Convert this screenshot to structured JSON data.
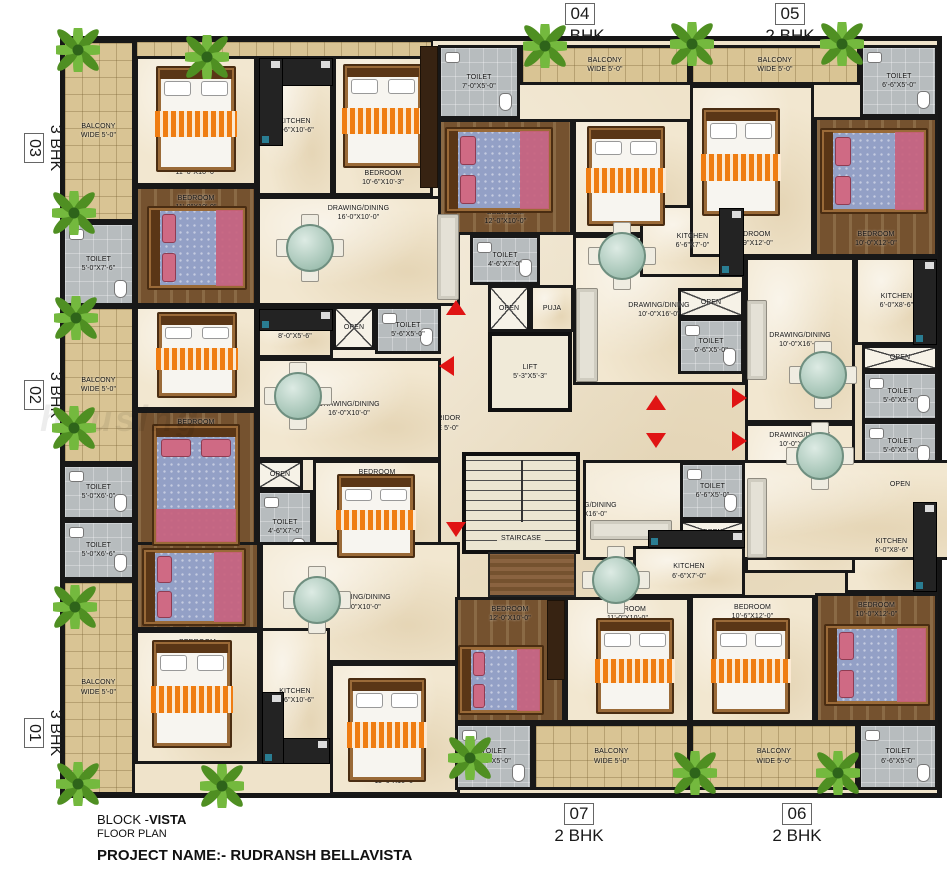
{
  "footer": {
    "block_prefix": "BLOCK -",
    "block_name": "VISTA",
    "floor_plan": "FLOOR PLAN",
    "project": "PROJECT NAME:- RUDRANSH BELLAVISTA"
  },
  "watermark": "housing",
  "units": [
    {
      "num": "04",
      "type": "2 BHK"
    },
    {
      "num": "05",
      "type": "2 BHK"
    },
    {
      "num": "03",
      "type": "3 BHK"
    },
    {
      "num": "02",
      "type": "3 BHK"
    },
    {
      "num": "01",
      "type": "3 BHK"
    },
    {
      "num": "07",
      "type": "2 BHK"
    },
    {
      "num": "06",
      "type": "2 BHK"
    }
  ],
  "colors": {
    "wall": "#181818",
    "arrow_red": "#e01414",
    "bed_orange": "#ef7d12",
    "bed_blue": "#93a0c6",
    "balcony_tan": "#d9c494",
    "toilet_gray": "#b7bcbe",
    "plant_green": "#74b93e"
  },
  "icons": {
    "plant": "plant-icon",
    "bed": "bed-icon",
    "dining_table": "dining-table-icon",
    "sofa": "sofa-icon",
    "counter": "kitchen-counter-icon",
    "arrow": "direction-arrow-icon"
  },
  "rooms": [
    {
      "id": "bal03",
      "name": "BALCONY",
      "dims": "WIDE 5'-0\""
    },
    {
      "id": "toi03",
      "name": "TOILET",
      "dims": "5'-0\"X7'-6\""
    },
    {
      "id": "bed03a",
      "name": "BEDROOM",
      "dims": "11'-0\"X10'-0\""
    },
    {
      "id": "bed03b",
      "name": "BEDROOM",
      "dims": "11'-0\"X10'-0\""
    },
    {
      "id": "kit03",
      "name": "KITCHEN",
      "dims": "6'-6\"X10'-6\""
    },
    {
      "id": "bed03c",
      "name": "BEDROOM",
      "dims": "10'-6\"X10'-3\""
    },
    {
      "id": "drw03",
      "name": "DRAWING/DINING",
      "dims": "16'-0\"X10'-0\""
    },
    {
      "id": "bal02",
      "name": "BALCONY",
      "dims": "WIDE 5'-0\""
    },
    {
      "id": "toi02a",
      "name": "TOILET",
      "dims": "5'-0\"X6'-0\""
    },
    {
      "id": "bed02a",
      "name": "BEDROOM",
      "dims": "12'-0\"X10'-0\""
    },
    {
      "id": "bed02b",
      "name": "BEDROOM",
      "dims": "12'-0\"X10'-0\""
    },
    {
      "id": "kit02",
      "name": "KITCHEN",
      "dims": "8'-0\"X5'-6\""
    },
    {
      "id": "open02",
      "name": "OPEN",
      "dims": ""
    },
    {
      "id": "toi02b",
      "name": "TOILET",
      "dims": "5'-6\"X5'-0\""
    },
    {
      "id": "drw02",
      "name": "DRAWING/DINING",
      "dims": "16'-0\"X10'-0\""
    },
    {
      "id": "open02b",
      "name": "OPEN",
      "dims": ""
    },
    {
      "id": "toi02c",
      "name": "TOILET",
      "dims": "4'-6\"X7'-0\""
    },
    {
      "id": "bed02c",
      "name": "BEDROOM",
      "dims": "11'-0\"X10'-0\""
    },
    {
      "id": "toi01",
      "name": "TOILET",
      "dims": "5'-0\"X6'-6\""
    },
    {
      "id": "bal01",
      "name": "BALCONY",
      "dims": "WIDE 5'-0\""
    },
    {
      "id": "bed01a",
      "name": "BEDROOM",
      "dims": "12'-0\"X10'-3\""
    },
    {
      "id": "bed01b",
      "name": "BEDROOM",
      "dims": "12'-0\"X11'-0\""
    },
    {
      "id": "drw01",
      "name": "DRAWING/DINING",
      "dims": "17'-0\"X10'-0\""
    },
    {
      "id": "kit01",
      "name": "KITCHEN",
      "dims": "5'-6\"X10'-6\""
    },
    {
      "id": "bed01c",
      "name": "BEDROOM",
      "dims": "11'-6\"X10'-6\""
    },
    {
      "id": "toi04a",
      "name": "TOILET",
      "dims": "7'-0\"X5'-0\""
    },
    {
      "id": "bal04",
      "name": "BALCONY",
      "dims": "WIDE 5'-0\""
    },
    {
      "id": "bed04a",
      "name": "BEDROOM",
      "dims": "12'-0\"X10'-0\""
    },
    {
      "id": "bed04b",
      "name": "BEDROOM",
      "dims": "11'-0\"X10'-0\""
    },
    {
      "id": "drw04",
      "name": "DRAWING/DINING",
      "dims": "10'-0\"X16'-0\""
    },
    {
      "id": "kit04",
      "name": "KITCHEN",
      "dims": "6'-6\"X7'-0\""
    },
    {
      "id": "toi04b",
      "name": "TOILET",
      "dims": "4'-6\"X7'-0\""
    },
    {
      "id": "open04",
      "name": "OPEN",
      "dims": ""
    },
    {
      "id": "puja04",
      "name": "PUJA",
      "dims": ""
    },
    {
      "id": "open04b",
      "name": "OPEN",
      "dims": ""
    },
    {
      "id": "toi04c",
      "name": "TOILET",
      "dims": "6'-6\"X5'-0\""
    },
    {
      "id": "bal05",
      "name": "BALCONY",
      "dims": "WIDE 5'-0\""
    },
    {
      "id": "toi05a",
      "name": "TOILET",
      "dims": "6'-6\"X5'-0\""
    },
    {
      "id": "bed05a",
      "name": "BEDROOM",
      "dims": "10'-9\"X12'-0\""
    },
    {
      "id": "bed05b",
      "name": "BEDROOM",
      "dims": "10'-0\"X12'-0\""
    },
    {
      "id": "kit05",
      "name": "KITCHEN",
      "dims": "6'-0\"X8'-6\""
    },
    {
      "id": "drw05",
      "name": "DRAWING/DINING",
      "dims": "10'-0\"X16'-0\""
    },
    {
      "id": "open05",
      "name": "OPEN",
      "dims": ""
    },
    {
      "id": "toi05b",
      "name": "TOILET",
      "dims": "5'-6\"X5'-0\""
    },
    {
      "id": "toi06b",
      "name": "TOILET",
      "dims": "5'-6\"X5'-0\""
    },
    {
      "id": "open06",
      "name": "OPEN",
      "dims": ""
    },
    {
      "id": "kit06",
      "name": "KITCHEN",
      "dims": "6'-0\"X8'-6\""
    },
    {
      "id": "drw06",
      "name": "DRAWING/DINING",
      "dims": "10'-0\"X16'-0\""
    },
    {
      "id": "bed06a",
      "name": "BEDROOM",
      "dims": "10'-0\"X12'-0\""
    },
    {
      "id": "bed06b",
      "name": "BEDROOM",
      "dims": "10'-6\"X12'-0\""
    },
    {
      "id": "toi06a",
      "name": "TOILET",
      "dims": "6'-6\"X5'-0\""
    },
    {
      "id": "bal06",
      "name": "BALCONY",
      "dims": "WIDE 5'-0\""
    },
    {
      "id": "drw07",
      "name": "DRAWING/DINING",
      "dims": "10'-0\"X16'-0\""
    },
    {
      "id": "toi07b",
      "name": "TOILET",
      "dims": "6'-6\"X5'-0\""
    },
    {
      "id": "open07",
      "name": "OPEN",
      "dims": ""
    },
    {
      "id": "kit07",
      "name": "KITCHEN",
      "dims": "6'-6\"X7'-0\""
    },
    {
      "id": "bed07a",
      "name": "BEDROOM",
      "dims": "11'-0\"X10'-0\""
    },
    {
      "id": "bed07b",
      "name": "BEDROOM",
      "dims": "12'-0\"X10'-0\""
    },
    {
      "id": "toi07a",
      "name": "TOILET",
      "dims": "7'-0\"X5'-0\""
    },
    {
      "id": "bal07",
      "name": "BALCONY",
      "dims": "WIDE 5'-0\""
    },
    {
      "id": "corrH",
      "name": "CORRIDOR",
      "dims": "WIDE 5'-0\""
    },
    {
      "id": "lift",
      "name": "LIFT",
      "dims": "5'-3\"X5'-3\""
    },
    {
      "id": "stair",
      "name": "STAIRCASE",
      "dims": ""
    }
  ]
}
